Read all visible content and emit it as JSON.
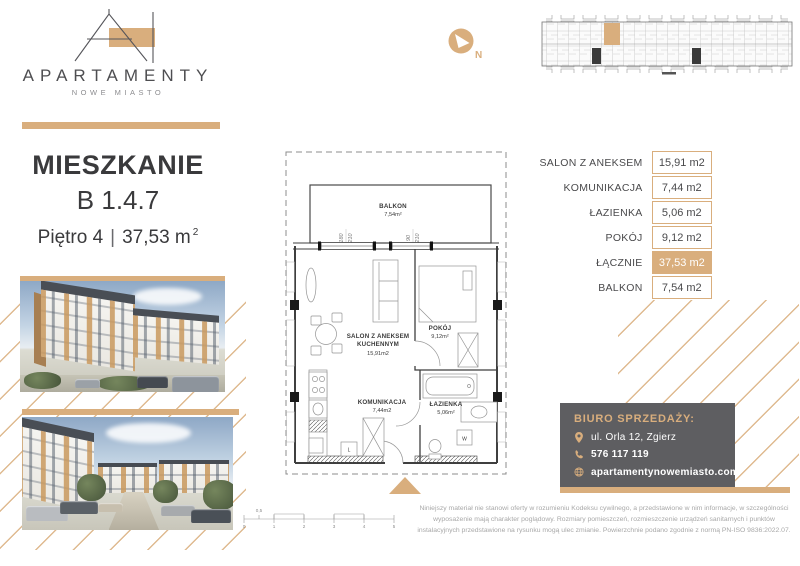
{
  "colors": {
    "accent": "#d9ae7d",
    "office_box": "#5e5e61"
  },
  "brand": {
    "logo_title": "APARTAMENTY",
    "logo_subtitle": "NOWE MIASTO"
  },
  "unit_header": {
    "kind": "MIESZKANIE",
    "code": "B 1.4.7",
    "floor": "Piętro 4",
    "separator": "|",
    "area": "37,53 m",
    "area_sup": "2"
  },
  "compass": {
    "north_label": "N"
  },
  "floorplan": {
    "balkon_label": "BALKON",
    "balkon_area": "7,54m²",
    "salon_label_1": "SALON Z ANEKSEM",
    "salon_label_2": "KUCHENNYM",
    "salon_area": "15,91m2",
    "pokoj_label": "POKÓJ",
    "pokoj_area": "9,12m²",
    "komunikacja_label": "KOMUNIKACJA",
    "komunikacja_area": "7,44m2",
    "lazienka_label": "ŁAZIENKA",
    "lazienka_area": "5,06m²",
    "washer_label": "W",
    "fridge_label": "L",
    "window1_width": "180",
    "window1_height": "210",
    "window2_width": "90",
    "window2_height": "210",
    "scale_bar": {
      "half": "0,5",
      "ticks": [
        "0",
        "1",
        "2",
        "3",
        "4",
        "5"
      ]
    }
  },
  "area_table": {
    "rows": [
      {
        "label": "SALON Z ANEKSEM",
        "value": "15,91 m2"
      },
      {
        "label": "KOMUNIKACJA",
        "value": "7,44 m2"
      },
      {
        "label": "ŁAZIENKA",
        "value": "5,06 m2"
      },
      {
        "label": "POKÓJ",
        "value": "9,12 m2"
      },
      {
        "label": "ŁĄCZNIE",
        "value": "37,53 m2",
        "highlight": true
      },
      {
        "label": "BALKON",
        "value": "7,54 m2"
      }
    ]
  },
  "sales_office": {
    "title": "BIURO SPRZEDAŻY:",
    "address": "ul. Orla 12, Zgierz",
    "phone": "576 117 119",
    "website": "apartamentynowemiasto.com"
  },
  "disclaimer": "Niniejszy materiał nie stanowi oferty w rozumieniu Kodeksu cywilnego, a przedstawione w nim informacje, w szczególności wyposażenie mają charakter poglądowy. Rozmiary pomieszczeń, rozmieszczenie urządzeń sanitarnych i punktów instalacyjnych przedstawione na rysunku mogą ulec zmianie. Powierzchnie podano zgodnie z normą PN-ISO 9836:2022.07."
}
